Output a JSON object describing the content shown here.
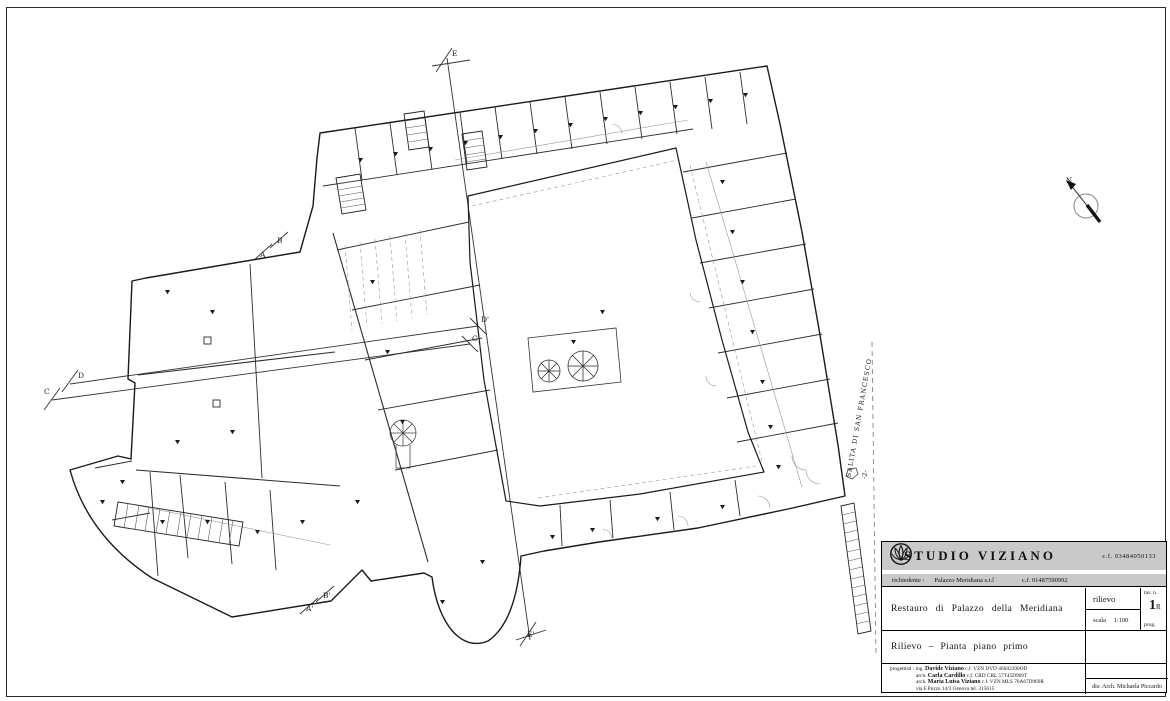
{
  "plan": {
    "north_label": "N",
    "street_label": "SALITA DI SAN FRANCESCO",
    "level_label": "-2-",
    "markers": [
      {
        "id": "e-top",
        "label": "E"
      },
      {
        "id": "a",
        "label": "A"
      },
      {
        "id": "b",
        "label": "B"
      },
      {
        "id": "c-left",
        "label": "C"
      },
      {
        "id": "d-left",
        "label": "D"
      },
      {
        "id": "c-right",
        "label": "C'"
      },
      {
        "id": "d-right",
        "label": "D'"
      },
      {
        "id": "a-bottom",
        "label": "A'"
      },
      {
        "id": "b-bottom",
        "label": "B'"
      },
      {
        "id": "e-bottom",
        "label": "E'"
      }
    ]
  },
  "title_block": {
    "studio_name": "STUDIO  VIZIANO",
    "studio_cf": "c.f. 03484050133",
    "client_label": "richiedente :",
    "client_name": "Palazzo Meridiana s.r.l",
    "client_cf": "c.f. 01487590992",
    "project_title": "Restauro di Palazzo della Meridiana",
    "type_value": "rilievo",
    "scale_label": "scala",
    "scale_value": "1:100",
    "sheet_label": "tav. n.",
    "sheet_number": "1",
    "sheet_rev": "R",
    "prog_label": "prog.",
    "drawing_title": "Rilievo – Pianta piano primo",
    "team_label": "progettisti : ing.",
    "designers": [
      {
        "role": "",
        "name": "Davide Viziano",
        "cf": "c.f. VZN DVD 46S02390OD"
      },
      {
        "role": "arch.",
        "name": "Carla Cardillo",
        "cf": "c.f. CRD CRL 57T45D969T"
      },
      {
        "role": "arch.",
        "name": "Maria Luisa Viziano",
        "cf": "c.f. VZN MLS 76A67D969R"
      }
    ],
    "address": "via F.Pozzo 14/3 Genova tel. 315615",
    "drafter": "dis: Arch. Michaela Piccardo"
  }
}
